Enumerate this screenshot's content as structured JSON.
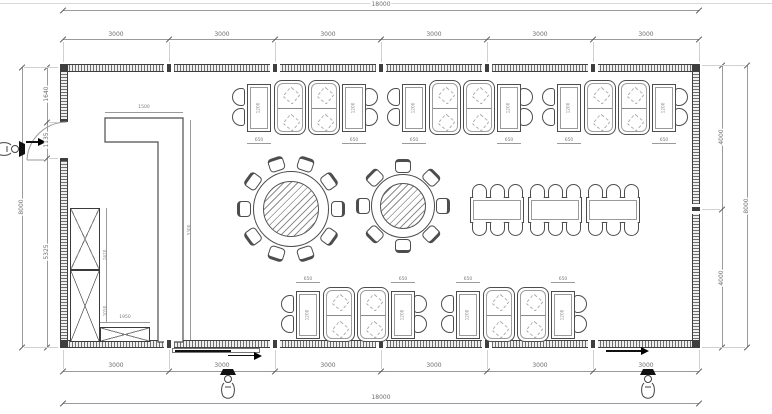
{
  "drawing": {
    "type": "restaurant-floor-plan",
    "dims": {
      "top_overall": "18000",
      "bottom_overall": "18000",
      "top_segments": [
        "3000",
        "3000",
        "3000",
        "3000",
        "3000",
        "3000"
      ],
      "bottom_segments": [
        "3000",
        "3000",
        "3000",
        "3000",
        "3000",
        "3000"
      ],
      "left_outer": "8000",
      "left_segments": [
        "1640",
        "1135",
        "5325"
      ],
      "right_outer": "8000",
      "right_segments": [
        "4000",
        "4000"
      ],
      "counter_top_width": "1500",
      "counter_length": "5300",
      "cabinet_height_upper": "2420",
      "cabinet_height_lower": "1050",
      "low_cabinet_width": "1950",
      "booth_table_length": "1200",
      "booth_table_width": "650"
    }
  },
  "furniture": {
    "round_tables": [
      {
        "label": "round-table-10-seats",
        "seats": 10
      },
      {
        "label": "round-table-8-seats",
        "seats": 8
      }
    ],
    "banquet_table": {
      "segments": 3,
      "chairs_per_side": 3
    },
    "booth_rows": {
      "top_clusters": 3,
      "bottom_clusters": 2
    },
    "casework": {
      "bar_counter": "L-counter",
      "cabinet": "tall-cabinet",
      "low_cabinet": "low-cabinet"
    }
  },
  "colors": {
    "wall": "#3f3f3f",
    "furniture_line": "#4d4d4d",
    "dim_line": "#9a9a9a",
    "dim_text": "#6e6e6e",
    "background": "#ffffff"
  }
}
